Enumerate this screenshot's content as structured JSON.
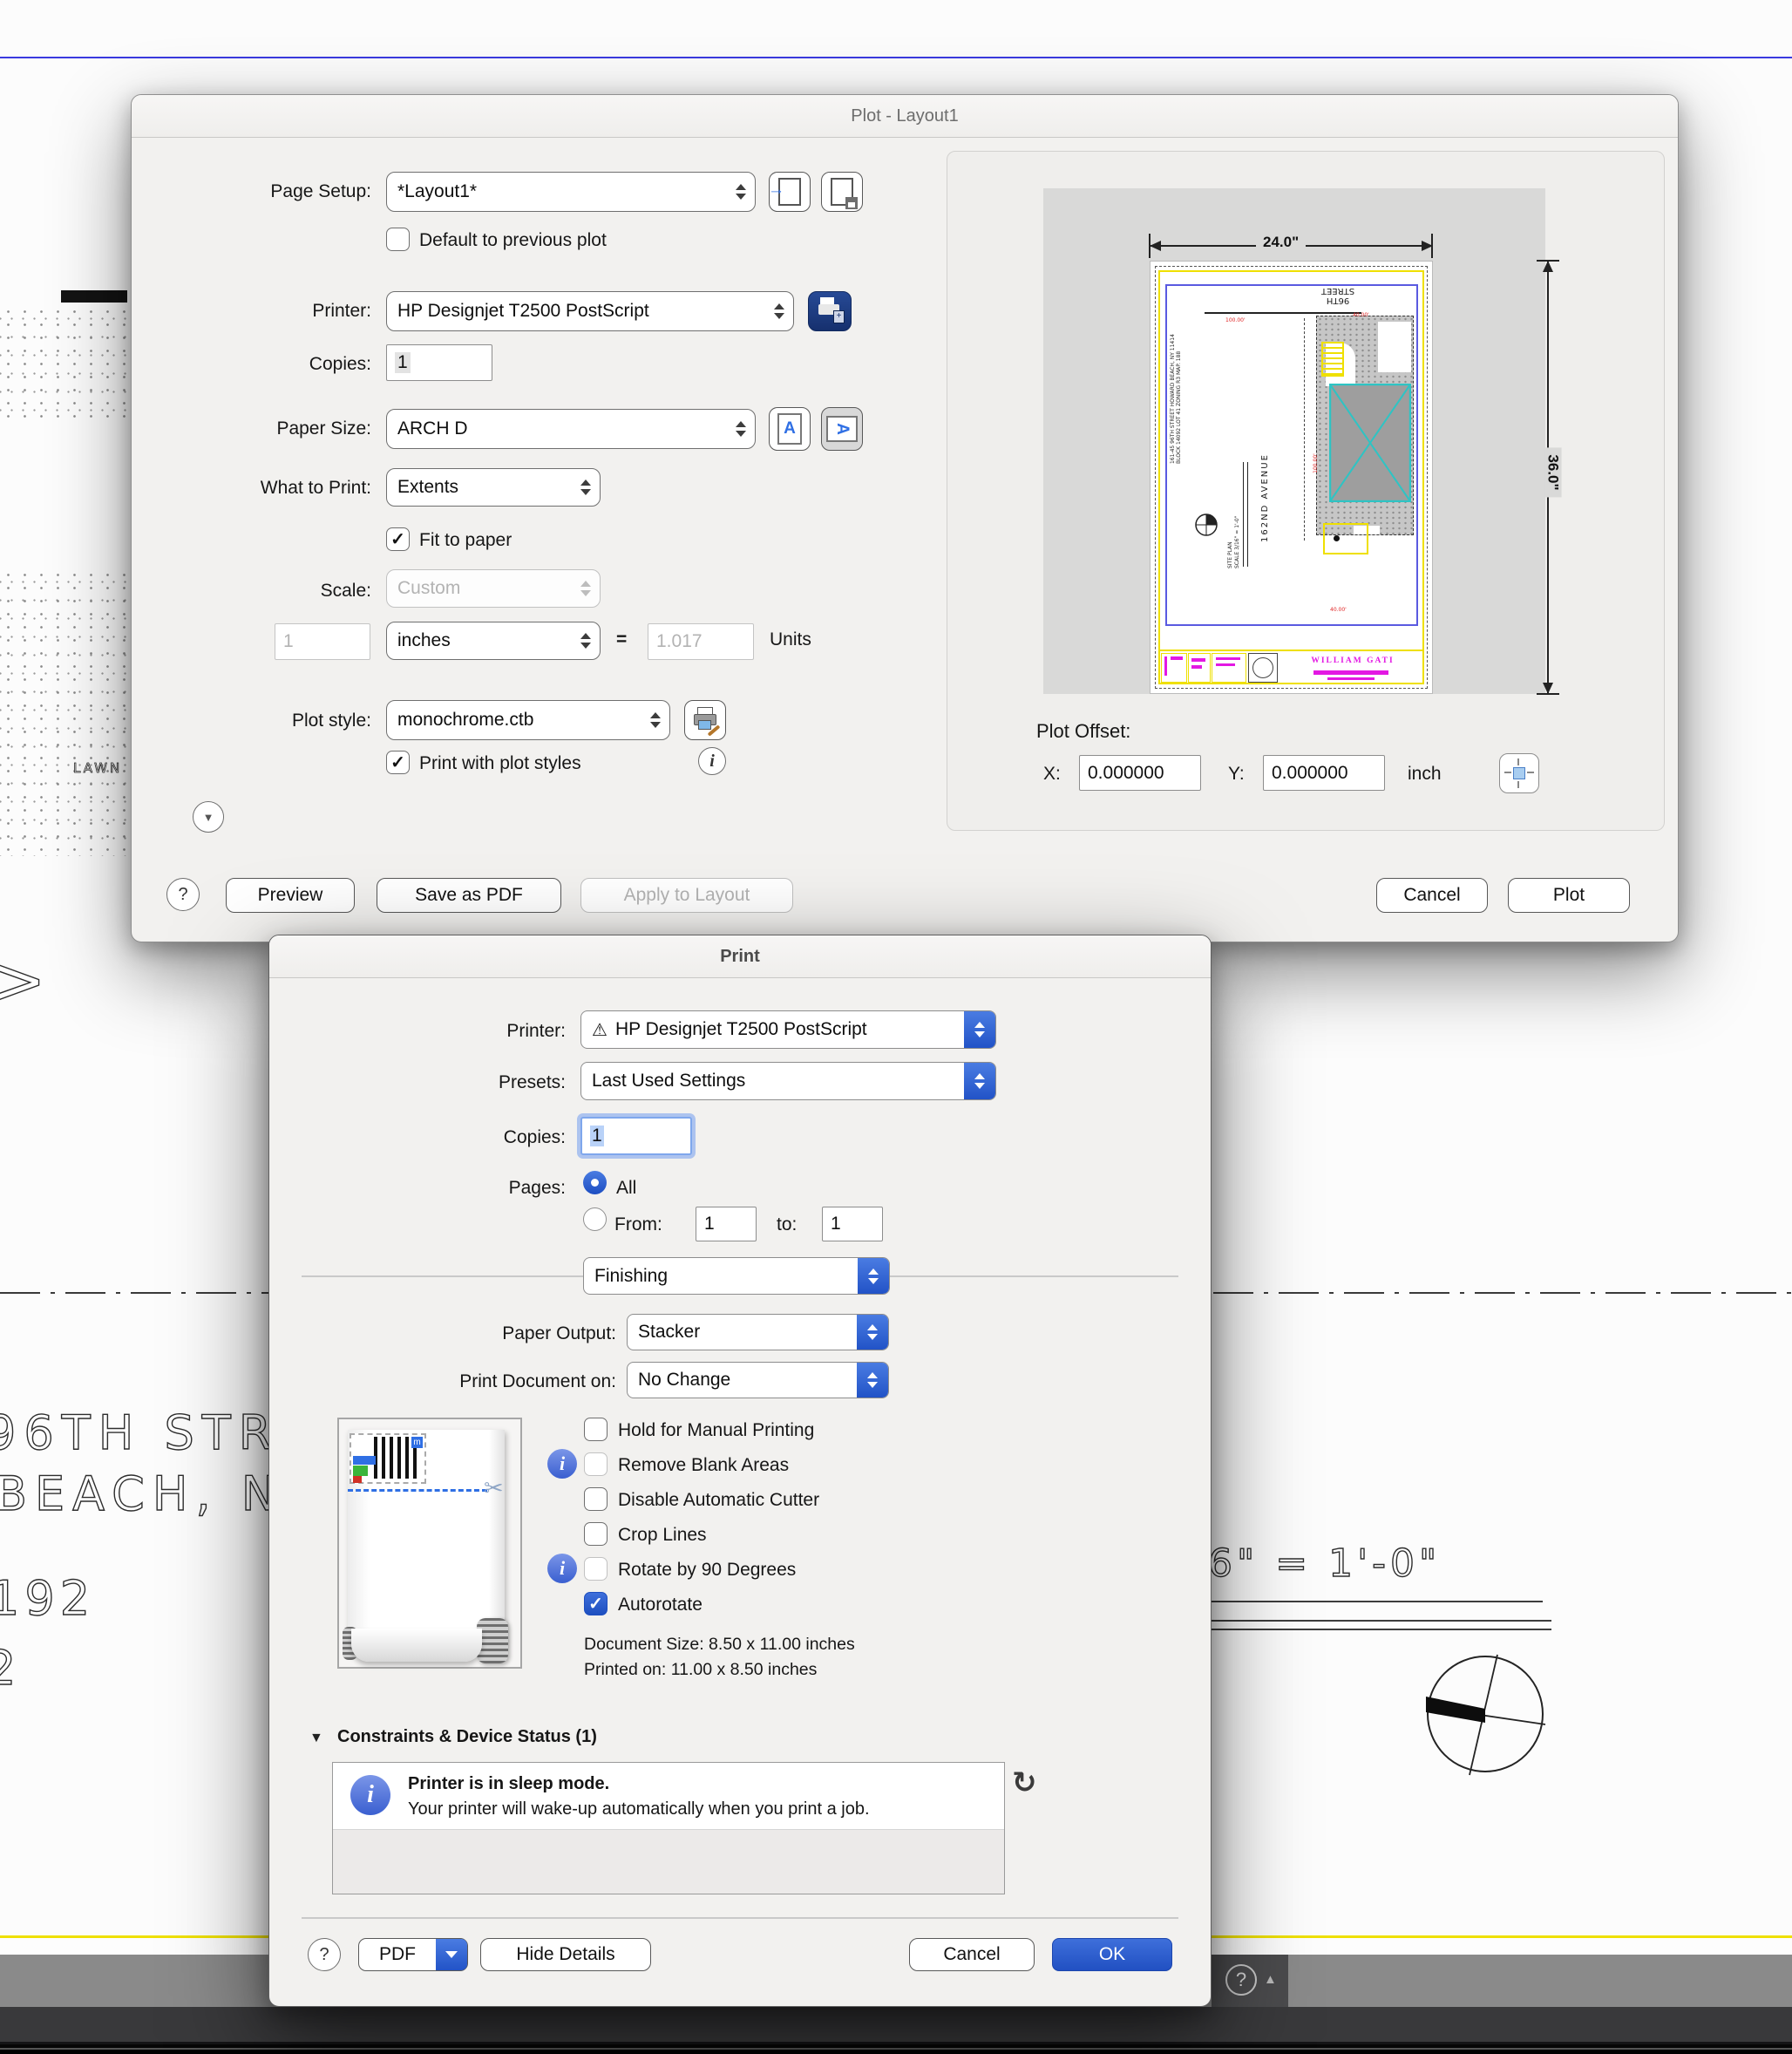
{
  "glyphs": {
    "check": "✓",
    "warning": "⚠",
    "help": "?",
    "refresh": "↻",
    "scissors": "✂",
    "triangle_down": "▼",
    "triangle_up": "▲",
    "import_arrow": "→",
    "compass_cross": "⊕"
  },
  "background": {
    "street_text": "96TH STRE",
    "city_text": "BEACH, NY",
    "number_192": "192",
    "number_2": "2",
    "lawn": "LAWN",
    "chevron": ">",
    "scale_note": "6\" = 1'-0\""
  },
  "taskbar": {
    "help": "?"
  },
  "plot_dialog": {
    "title": "Plot - Layout1",
    "page_setup_label": "Page Setup:",
    "page_setup_value": "*Layout1*",
    "default_checkbox": "Default to previous plot",
    "printer_label": "Printer:",
    "printer_value": "HP Designjet T2500 PostScript",
    "copies_label": "Copies:",
    "copies_value": "1",
    "paper_size_label": "Paper Size:",
    "paper_size_value": "ARCH D",
    "what_to_print_label": "What to Print:",
    "what_to_print_value": "Extents",
    "fit_to_paper": "Fit to paper",
    "scale_label": "Scale:",
    "scale_value": "Custom",
    "scale_number": "1",
    "scale_unit": "inches",
    "equals": "=",
    "scale_result": "1.017",
    "units_label": "Units",
    "plot_style_label": "Plot style:",
    "plot_style_value": "monochrome.ctb",
    "print_with_styles": "Print with plot styles",
    "preview": {
      "width_dim": "24.0\"",
      "height_dim": "36.0\"",
      "street_line1": "96TH",
      "street_line2": "STREET",
      "avenue": "162ND AVENUE",
      "address": "161-45 96TH STREET HOWARD BEACH, NY 11414 BLOCK 14092 LOT 41 ZONING R3 MAP. 188",
      "site_plan": "SITE PLAN",
      "site_scale": "SCALE 3/16\" = 1'-0\"",
      "architect": "WILLIAM GATI",
      "dim1": "100.00'",
      "dim2": "40.00'",
      "dim3": "100.00'",
      "dim4": "40.00'"
    },
    "plot_offset_label": "Plot Offset:",
    "x_label": "X:",
    "x_value": "0.000000",
    "y_label": "Y:",
    "y_value": "0.000000",
    "offset_unit": "inch",
    "help": "?",
    "preview_button": "Preview",
    "save_pdf_button": "Save as PDF",
    "apply_button": "Apply to Layout",
    "cancel_button": "Cancel",
    "plot_button": "Plot"
  },
  "print_dialog": {
    "title": "Print",
    "printer_label": "Printer:",
    "printer_value": "HP Designjet T2500 PostScript",
    "presets_label": "Presets:",
    "presets_value": "Last Used Settings",
    "copies_label": "Copies:",
    "copies_value": "1",
    "pages_label": "Pages:",
    "all_label": "All",
    "from_label": "From:",
    "from_value": "1",
    "to_label": "to:",
    "to_value": "1",
    "section_value": "Finishing",
    "paper_output_label": "Paper Output:",
    "paper_output_value": "Stacker",
    "print_doc_label": "Print Document on:",
    "print_doc_value": "No Change",
    "checkboxes": [
      {
        "label": "Hold for Manual Printing",
        "checked": false,
        "disabled": false,
        "info": false
      },
      {
        "label": "Remove Blank Areas",
        "checked": false,
        "disabled": true,
        "info": true
      },
      {
        "label": "Disable Automatic Cutter",
        "checked": false,
        "disabled": false,
        "info": false
      },
      {
        "label": "Crop Lines",
        "checked": false,
        "disabled": false,
        "info": false
      },
      {
        "label": "Rotate by 90 Degrees",
        "checked": false,
        "disabled": true,
        "info": true
      },
      {
        "label": "Autorotate",
        "checked": true,
        "disabled": false,
        "info": false
      }
    ],
    "doc_size": "Document Size: 8.50 x 11.00 inches",
    "printed_on": "Printed on: 11.00 x 8.50 inches",
    "constraints_header": "Constraints & Device Status (1)",
    "status_title": "Printer is in sleep mode.",
    "status_desc": "Your printer will wake-up automatically when you print a job.",
    "help": "?",
    "pdf_button": "PDF",
    "hide_details_button": "Hide Details",
    "cancel_button": "Cancel",
    "ok_button": "OK"
  }
}
